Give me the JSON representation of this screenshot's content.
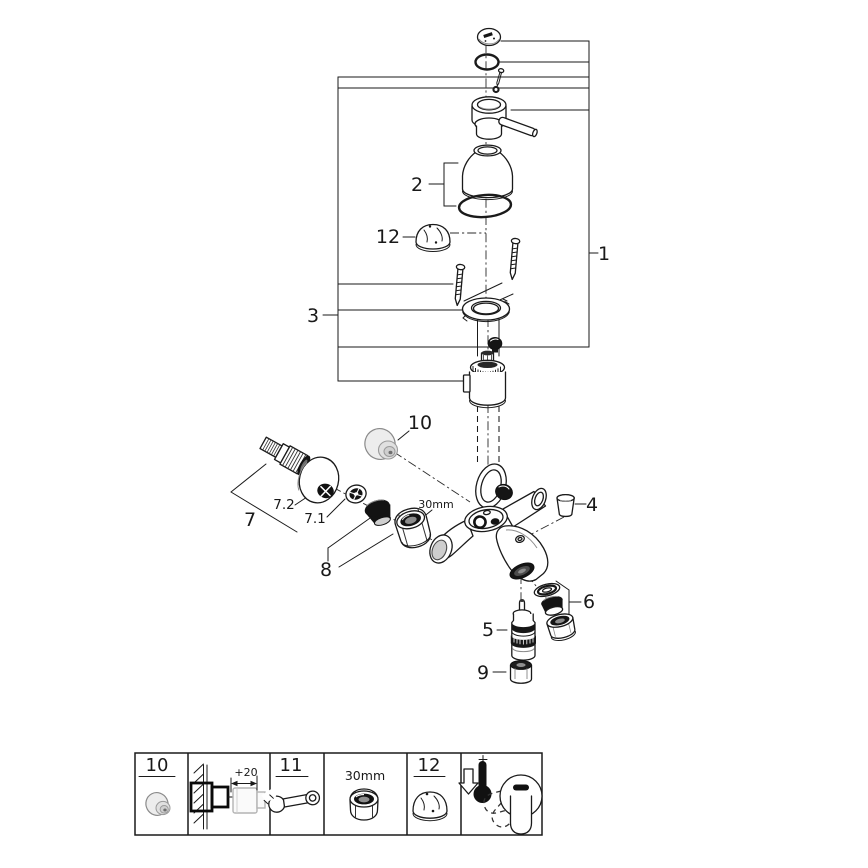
{
  "diagram": {
    "callouts": {
      "c1": "1",
      "c2": "2",
      "c3": "3",
      "c4": "4",
      "c5": "5",
      "c6": "6",
      "c7": "7",
      "c71": "7.1",
      "c72": "7.2",
      "c8": "8",
      "c9": "9",
      "c10": "10",
      "c12": "12",
      "nut_size": "30mm"
    },
    "parts": [
      {
        "id": "1",
        "name": "lever-handle-assembly"
      },
      {
        "id": "2",
        "name": "cartridge-sleeve-with-o-ring"
      },
      {
        "id": "3",
        "name": "escutcheon-mounting-set"
      },
      {
        "id": "4",
        "name": "plug-cap"
      },
      {
        "id": "5",
        "name": "diverter-cartridge"
      },
      {
        "id": "6",
        "name": "aerator-set"
      },
      {
        "id": "7",
        "name": "s-union-set"
      },
      {
        "id": "7.1",
        "name": "washer"
      },
      {
        "id": "7.2",
        "name": "escutcheon"
      },
      {
        "id": "8",
        "name": "filter-cone-and-union-nut"
      },
      {
        "id": "9",
        "name": "diverter-knob"
      },
      {
        "id": "10",
        "name": "cover-cap"
      },
      {
        "id": "12",
        "name": "mounting-cap"
      }
    ]
  },
  "legend": {
    "n10": "10",
    "depth": "+20",
    "n11": "11",
    "nut": "30mm",
    "n12": "12",
    "icons": [
      "cap-nut-icon",
      "wall-mount-depth-icon",
      "wrench-icon",
      "nut-30mm-icon",
      "dome-cap-icon",
      "cold-temperature-lever-icon"
    ]
  },
  "colors": {
    "line": "#1a1a1a",
    "dark_fill": "#151515",
    "grey_part_fill": "#ededed",
    "grey_part_stroke": "#8a8a8a",
    "ghost_grey": "#b3b3b3",
    "background": "#ffffff"
  }
}
